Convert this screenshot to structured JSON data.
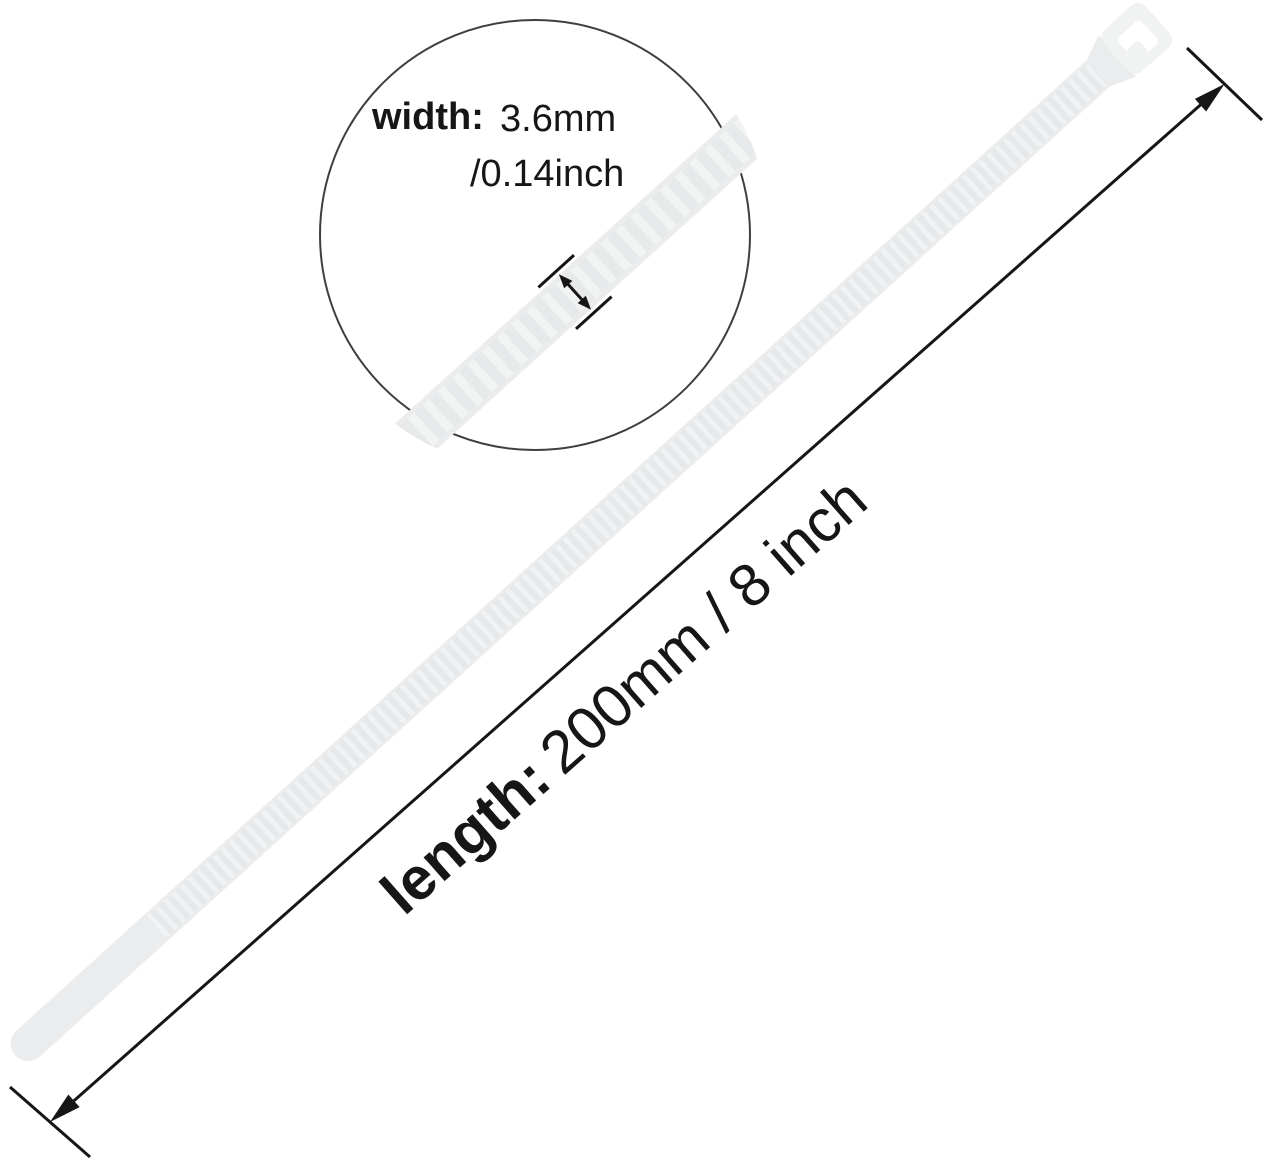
{
  "title": "Cable tie dimension diagram",
  "magnifier": {
    "width_label": "width:",
    "width_value_mm": "3.6mm",
    "width_value_inch": "/0.14inch"
  },
  "length_dimension": {
    "label": "length:",
    "value": "200mm / 8 inch"
  },
  "colors": {
    "background": "#ffffff",
    "tie_base": "#ebeced",
    "tie_head": "#f1f2f2",
    "slot_white": "#ffffff",
    "line": "#161616",
    "circle_stroke": "#3f3f3f"
  }
}
